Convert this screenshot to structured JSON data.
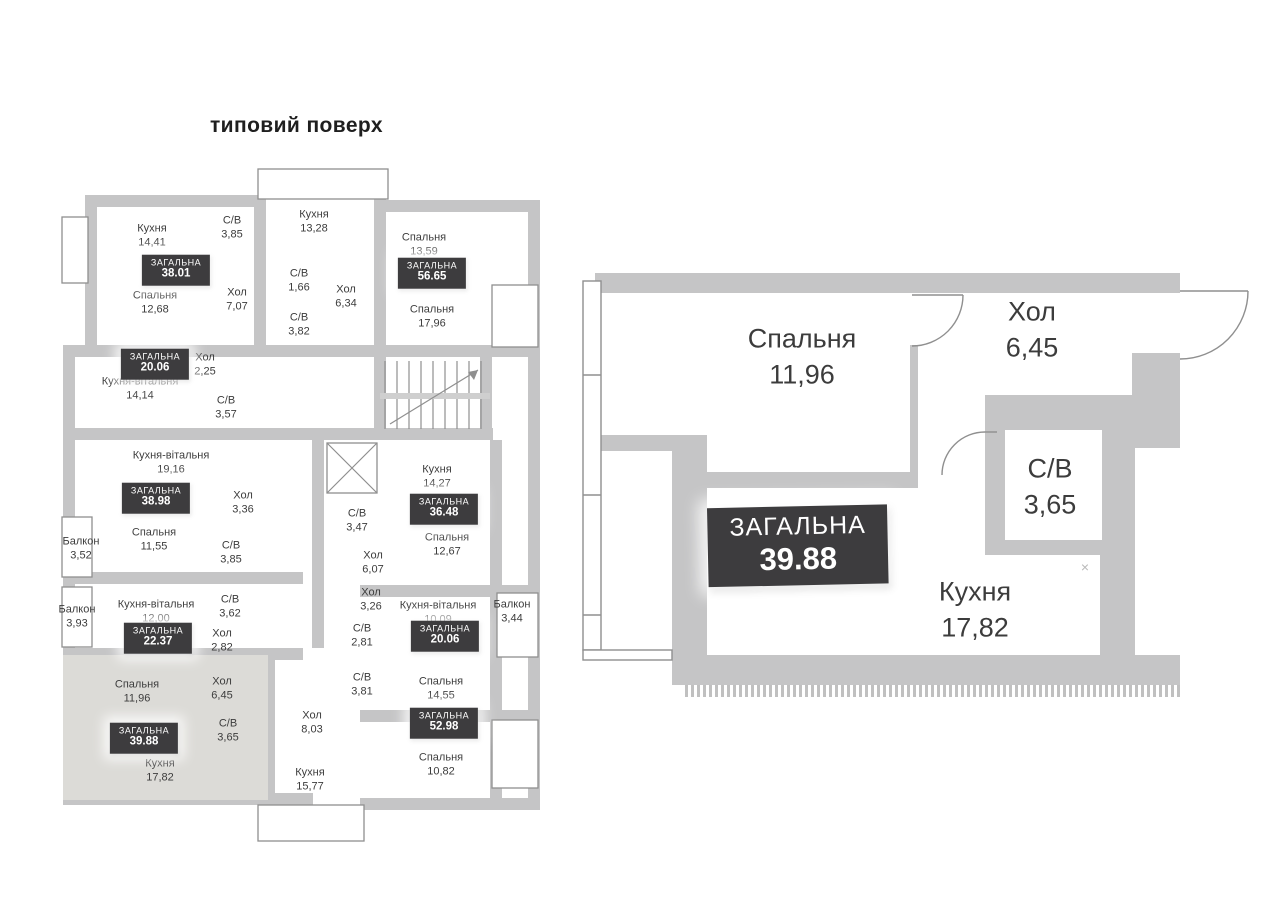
{
  "title": "типовий поверх",
  "badge_label": "ЗАГАЛЬНА",
  "colors": {
    "wall": "#c5c5c6",
    "badge_bg": "#3d3c3e",
    "badge_text": "#ffffff",
    "room_text": "#3c3c3c",
    "highlight_fill": "#dcdbd7"
  },
  "overview": {
    "rooms": [
      {
        "name": "Кухня",
        "area": "14,41",
        "cx": 92,
        "cy": 71
      },
      {
        "name": "С/В",
        "area": "3,85",
        "cx": 172,
        "cy": 63
      },
      {
        "name": "Кухня",
        "area": "13,28",
        "cx": 254,
        "cy": 57
      },
      {
        "name": "Спальня",
        "area": "13,59",
        "cx": 364,
        "cy": 80
      },
      {
        "name": "Спальня",
        "area": "12,68",
        "cx": 95,
        "cy": 138
      },
      {
        "name": "Хол",
        "area": "7,07",
        "cx": 177,
        "cy": 135
      },
      {
        "name": "С/В",
        "area": "1,66",
        "cx": 239,
        "cy": 116
      },
      {
        "name": "Хол",
        "area": "6,34",
        "cx": 286,
        "cy": 132
      },
      {
        "name": "С/В",
        "area": "3,82",
        "cx": 239,
        "cy": 160
      },
      {
        "name": "Спальня",
        "area": "17,96",
        "cx": 372,
        "cy": 152
      },
      {
        "name": "Хол",
        "area": "2,25",
        "cx": 145,
        "cy": 200
      },
      {
        "name": "Кухня-вітальня",
        "area": "14,14",
        "cx": 80,
        "cy": 224
      },
      {
        "name": "С/В",
        "area": "3,57",
        "cx": 166,
        "cy": 243
      },
      {
        "name": "Кухня-вітальня",
        "area": "19,16",
        "cx": 111,
        "cy": 298
      },
      {
        "name": "Хол",
        "area": "3,36",
        "cx": 183,
        "cy": 338
      },
      {
        "name": "Балкон",
        "area": "3,52",
        "cx": 21,
        "cy": 384
      },
      {
        "name": "Спальня",
        "area": "11,55",
        "cx": 94,
        "cy": 375
      },
      {
        "name": "С/В",
        "area": "3,85",
        "cx": 171,
        "cy": 388
      },
      {
        "name": "Кухня",
        "area": "14,27",
        "cx": 377,
        "cy": 312
      },
      {
        "name": "Спальня",
        "area": "12,67",
        "cx": 387,
        "cy": 380
      },
      {
        "name": "С/В",
        "area": "3,47",
        "cx": 297,
        "cy": 356
      },
      {
        "name": "Хол",
        "area": "6,07",
        "cx": 313,
        "cy": 398
      },
      {
        "name": "Балкон",
        "area": "3,93",
        "cx": 17,
        "cy": 452
      },
      {
        "name": "Кухня-вітальня",
        "area": "12,00",
        "cx": 96,
        "cy": 447
      },
      {
        "name": "С/В",
        "area": "3,62",
        "cx": 170,
        "cy": 442
      },
      {
        "name": "Хол",
        "area": "2,82",
        "cx": 162,
        "cy": 476
      },
      {
        "name": "Хол",
        "area": "3,26",
        "cx": 311,
        "cy": 435
      },
      {
        "name": "Кухня-вітальня",
        "area": "10,09",
        "cx": 378,
        "cy": 448
      },
      {
        "name": "Балкон",
        "area": "3,44",
        "cx": 452,
        "cy": 447
      },
      {
        "name": "С/В",
        "area": "2,81",
        "cx": 302,
        "cy": 471
      },
      {
        "name": "С/В",
        "area": "3,81",
        "cx": 302,
        "cy": 520
      },
      {
        "name": "Спальня",
        "area": "14,55",
        "cx": 381,
        "cy": 524
      },
      {
        "name": "Спальня",
        "area": "11,96",
        "cx": 77,
        "cy": 527
      },
      {
        "name": "Хол",
        "area": "6,45",
        "cx": 162,
        "cy": 524
      },
      {
        "name": "С/В",
        "area": "3,65",
        "cx": 168,
        "cy": 566
      },
      {
        "name": "Кухня",
        "area": "17,82",
        "cx": 100,
        "cy": 606
      },
      {
        "name": "Хол",
        "area": "8,03",
        "cx": 252,
        "cy": 558
      },
      {
        "name": "Кухня",
        "area": "15,77",
        "cx": 250,
        "cy": 615
      },
      {
        "name": "Спальня",
        "area": "10,82",
        "cx": 381,
        "cy": 600
      }
    ],
    "totals": [
      {
        "value": "38.01",
        "cx": 116,
        "cy": 105
      },
      {
        "value": "56.65",
        "cx": 372,
        "cy": 108
      },
      {
        "value": "20.06",
        "cx": 95,
        "cy": 199
      },
      {
        "value": "38.98",
        "cx": 96,
        "cy": 333
      },
      {
        "value": "36.48",
        "cx": 384,
        "cy": 344
      },
      {
        "value": "22.37",
        "cx": 98,
        "cy": 473
      },
      {
        "value": "20.06",
        "cx": 385,
        "cy": 471
      },
      {
        "value": "39.88",
        "cx": 84,
        "cy": 573
      },
      {
        "value": "52.98",
        "cx": 384,
        "cy": 558
      }
    ]
  },
  "detail": {
    "rooms": [
      {
        "name": "Спальня",
        "area": "11,96",
        "cx": 222,
        "cy": 92
      },
      {
        "name": "Хол",
        "area": "6,45",
        "cx": 452,
        "cy": 65
      },
      {
        "name": "С/В",
        "area": "3,65",
        "cx": 470,
        "cy": 222
      },
      {
        "name": "Кухня",
        "area": "17,82",
        "cx": 395,
        "cy": 345
      }
    ],
    "total": {
      "value": "39.88"
    },
    "marker": "×"
  }
}
